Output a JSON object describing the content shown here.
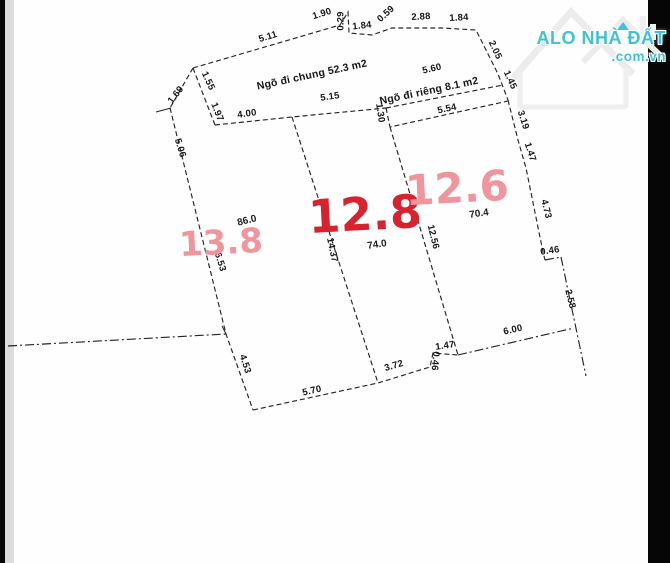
{
  "watermark": {
    "brand": "ALO NHÀ ĐẤT",
    "tld": ".com.vn",
    "color": "#3fc2d5"
  },
  "colors": {
    "plot_strong": "#d8232f",
    "plot_light": "#ee959d",
    "line": "#242424"
  },
  "diagram": {
    "alley_labels": [
      {
        "t": "Ngõ đi chung 52.3 m2",
        "x": 312,
        "y": 75,
        "r": -12
      },
      {
        "t": "Ngõ đi riêng 8.1 m2",
        "x": 429,
        "y": 91,
        "r": -12
      }
    ],
    "area_labels": [
      {
        "t": "13.8",
        "x": 221,
        "y": 243,
        "r": -3,
        "s": 34,
        "c": "#ee959d"
      },
      {
        "t": "12.8",
        "x": 365,
        "y": 214,
        "r": -3,
        "s": 46,
        "c": "#d8232f"
      },
      {
        "t": "12.6",
        "x": 457,
        "y": 188,
        "r": -3,
        "s": 42,
        "c": "#ee959d"
      }
    ],
    "area_sublabels": [
      {
        "t": "86.0",
        "x": 247,
        "y": 221,
        "r": -14
      },
      {
        "t": "74.0",
        "x": 377,
        "y": 245,
        "r": -8
      },
      {
        "t": "70.4",
        "x": 479,
        "y": 214,
        "r": -8
      }
    ],
    "dimension_labels": [
      {
        "t": "5.11",
        "x": 268,
        "y": 37,
        "r": -17
      },
      {
        "t": "1.90",
        "x": 322,
        "y": 14,
        "r": -17
      },
      {
        "t": "0.29",
        "x": 341,
        "y": 21,
        "r": -90
      },
      {
        "t": "1.84",
        "x": 362,
        "y": 26,
        "r": -6
      },
      {
        "t": "0.59",
        "x": 386,
        "y": 14,
        "r": -42
      },
      {
        "t": "2.88",
        "x": 421,
        "y": 17,
        "r": -3
      },
      {
        "t": "1.84",
        "x": 459,
        "y": 18,
        "r": -3
      },
      {
        "t": "2.05",
        "x": 495,
        "y": 50,
        "r": 65
      },
      {
        "t": "1.45",
        "x": 510,
        "y": 80,
        "r": 65
      },
      {
        "t": "1.69",
        "x": 176,
        "y": 95,
        "r": -52
      },
      {
        "t": "1.55",
        "x": 208,
        "y": 81,
        "r": 65
      },
      {
        "t": "1.97",
        "x": 217,
        "y": 112,
        "r": 68
      },
      {
        "t": "4.00",
        "x": 247,
        "y": 114,
        "r": -8
      },
      {
        "t": "5.15",
        "x": 330,
        "y": 97,
        "r": -8
      },
      {
        "t": "1.30",
        "x": 380,
        "y": 113,
        "r": 82
      },
      {
        "t": "5.60",
        "x": 432,
        "y": 69,
        "r": -13
      },
      {
        "t": "5.54",
        "x": 447,
        "y": 109,
        "r": -12
      },
      {
        "t": "5.06",
        "x": 180,
        "y": 148,
        "r": 73
      },
      {
        "t": "6.53",
        "x": 220,
        "y": 262,
        "r": 73
      },
      {
        "t": "4.53",
        "x": 245,
        "y": 364,
        "r": 72
      },
      {
        "t": "14.37",
        "x": 332,
        "y": 250,
        "r": 78
      },
      {
        "t": "12.56",
        "x": 433,
        "y": 237,
        "r": 76
      },
      {
        "t": "3.19",
        "x": 523,
        "y": 120,
        "r": 72
      },
      {
        "t": "1.47",
        "x": 530,
        "y": 152,
        "r": 72
      },
      {
        "t": "4.73",
        "x": 546,
        "y": 209,
        "r": 76
      },
      {
        "t": "0.46",
        "x": 550,
        "y": 251,
        "r": -8
      },
      {
        "t": "2.58",
        "x": 570,
        "y": 299,
        "r": 76
      },
      {
        "t": "5.70",
        "x": 312,
        "y": 391,
        "r": -13
      },
      {
        "t": "3.72",
        "x": 394,
        "y": 366,
        "r": -16
      },
      {
        "t": "0.46",
        "x": 435,
        "y": 361,
        "r": 95
      },
      {
        "t": "1.47",
        "x": 445,
        "y": 346,
        "r": -8
      },
      {
        "t": "6.00",
        "x": 513,
        "y": 330,
        "r": -13
      }
    ]
  }
}
